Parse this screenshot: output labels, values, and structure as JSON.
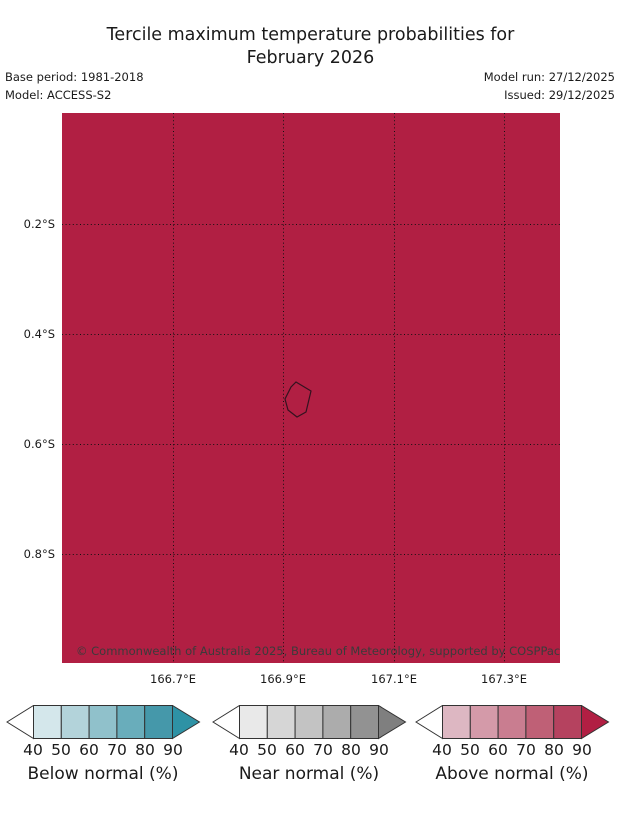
{
  "header": {
    "title": "Tercile maximum temperature probabilities for\nFebruary 2026",
    "base_period": "Base period: 1981-2018",
    "model": "Model: ACCESS-S2",
    "model_run": "Model run: 27/12/2025",
    "issued": "Issued: 29/12/2025"
  },
  "map": {
    "fill_color": "#b11f43",
    "gridline_color": "#111111",
    "island_outline_color": "#33121f",
    "copyright": "© Commonwealth of Australia 2025, Bureau of Meteorology, supported by COSPPac"
  },
  "axes": {
    "x": [
      "166.7°E",
      "166.9°E",
      "167.1°E",
      "167.3°E"
    ],
    "y": [
      "0.2°S",
      "0.4°S",
      "0.6°S",
      "0.8°S"
    ]
  },
  "chart_data": {
    "type": "heatmap",
    "title": "Tercile maximum temperature probabilities for February 2026",
    "x_axis": {
      "tick_labels": [
        "166.7°E",
        "166.9°E",
        "167.1°E",
        "167.3°E"
      ],
      "range_deg_east": [
        166.5,
        167.4
      ]
    },
    "y_axis": {
      "tick_labels": [
        "0.2°S",
        "0.4°S",
        "0.6°S",
        "0.8°S"
      ],
      "range_deg_south": [
        0.0,
        1.0
      ]
    },
    "grid": "dotted",
    "field": "tercile maximum temperature probability category",
    "map_value": "Above normal > 90% over entire shown domain",
    "map_fill_color": "#b11f43",
    "island_outline": {
      "approx_lon_e": 166.93,
      "approx_lat_s": 0.52
    },
    "legends": [
      {
        "label": "Below normal (%)",
        "ticks": [
          40,
          50,
          60,
          70,
          80,
          90
        ],
        "colors": [
          "#d4e7eb",
          "#b3d3da",
          "#90c1cb",
          "#69adbb",
          "#4598aa"
        ],
        "arrow_color": "#2e92a5"
      },
      {
        "label": "Near normal (%)",
        "ticks": [
          40,
          50,
          60,
          70,
          80,
          90
        ],
        "colors": [
          "#e9e9e9",
          "#d6d6d6",
          "#c3c3c3",
          "#acacac",
          "#929292"
        ],
        "arrow_color": "#7f7f7f"
      },
      {
        "label": "Above normal (%)",
        "ticks": [
          40,
          50,
          60,
          70,
          80,
          90
        ],
        "colors": [
          "#ddb7c2",
          "#d49aa9",
          "#c97d90",
          "#bf6076",
          "#b5425f"
        ],
        "arrow_color": "#b11f43"
      }
    ]
  },
  "legend": {
    "left_arrow_color": "#ffffff",
    "bars": [
      {
        "label": "Below normal (%)",
        "ticks": [
          "40",
          "50",
          "60",
          "70",
          "80",
          "90"
        ],
        "c0": "#d4e7eb",
        "c1": "#b3d3da",
        "c2": "#90c1cb",
        "c3": "#69adbb",
        "c4": "#4598aa",
        "arrow": "#2e92a5"
      },
      {
        "label": "Near normal (%)",
        "ticks": [
          "40",
          "50",
          "60",
          "70",
          "80",
          "90"
        ],
        "c0": "#e9e9e9",
        "c1": "#d6d6d6",
        "c2": "#c3c3c3",
        "c3": "#acacac",
        "c4": "#929292",
        "arrow": "#7f7f7f"
      },
      {
        "label": "Above normal (%)",
        "ticks": [
          "40",
          "50",
          "60",
          "70",
          "80",
          "90"
        ],
        "c0": "#ddb7c2",
        "c1": "#d49aa9",
        "c2": "#c97d90",
        "c3": "#bf6076",
        "c4": "#b5425f",
        "arrow": "#b11f43"
      }
    ]
  }
}
